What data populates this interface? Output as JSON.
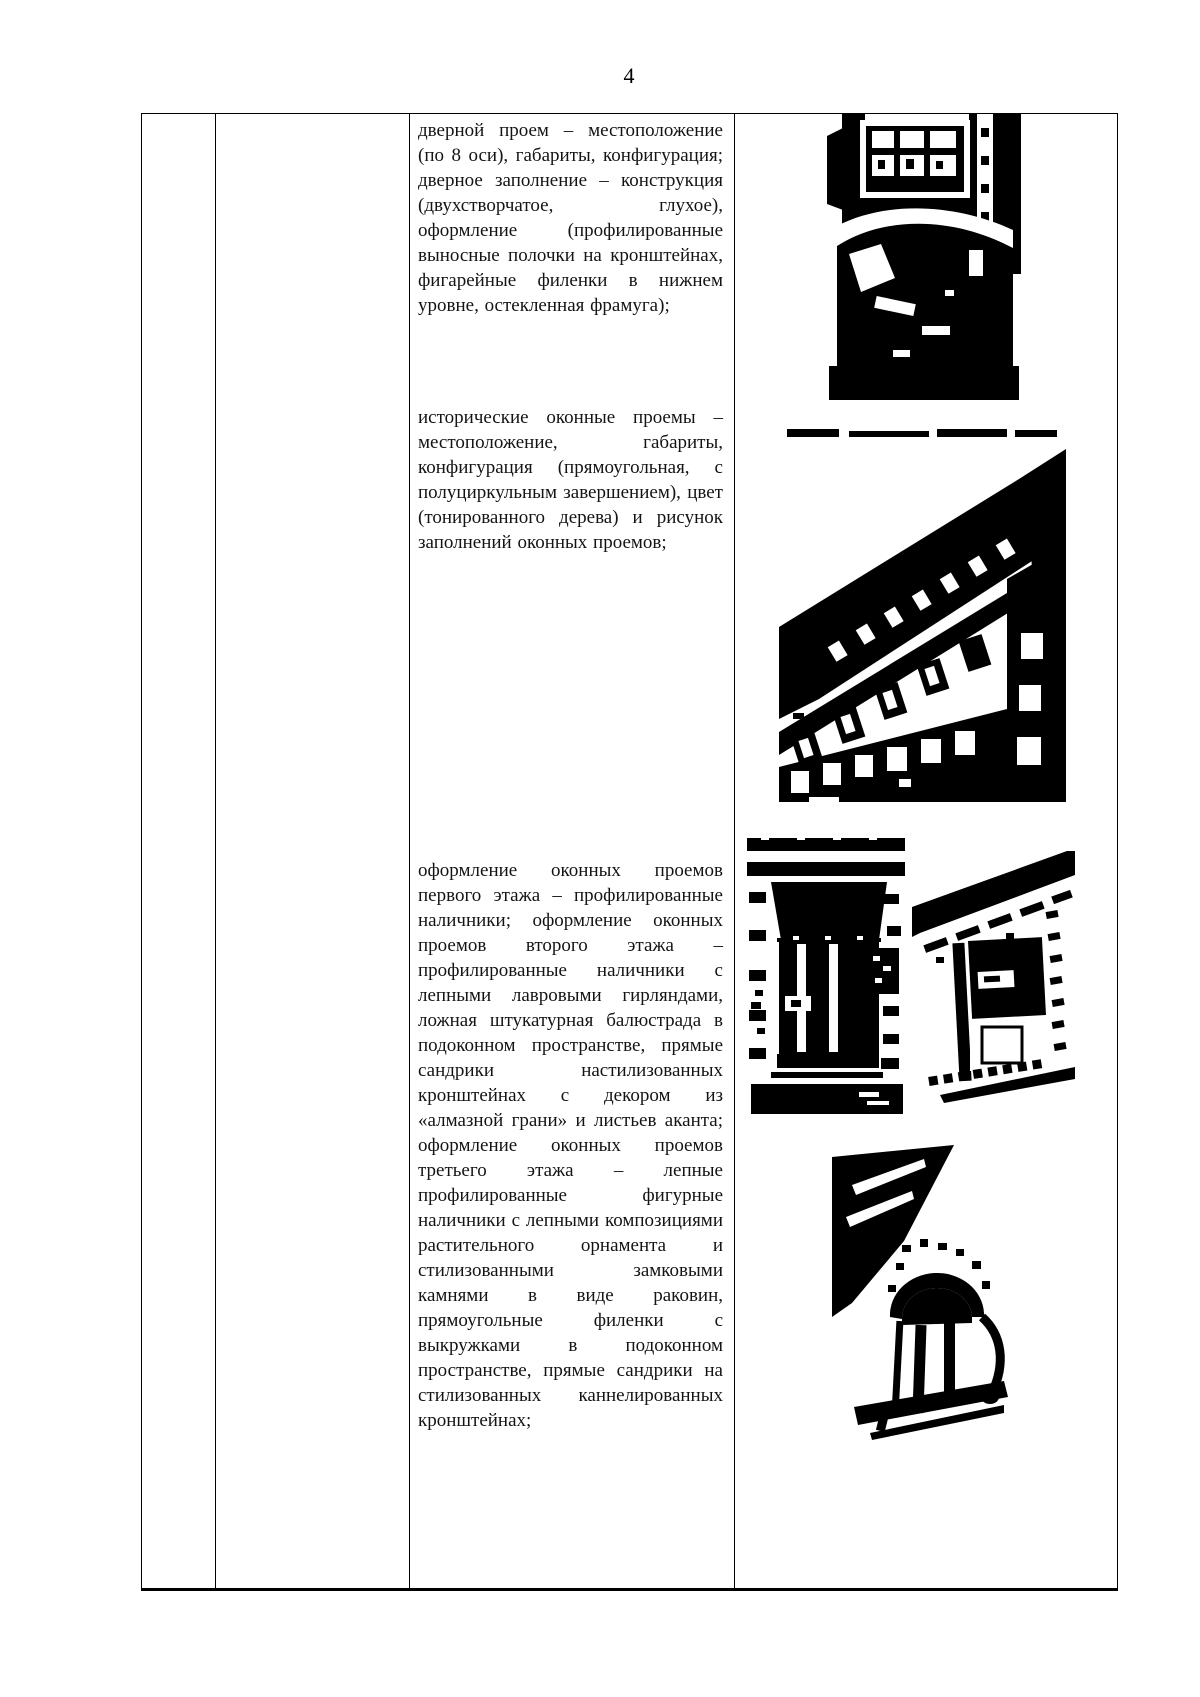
{
  "page_number": "4",
  "document": {
    "text_blocks": {
      "door": "дверной проем – местоположение (по 8 оси), габариты, конфигурация; дверное заполнение – конструкция (двухстворчатое, глухое), оформление (профилированные выносные полочки на кронштейнах, фигарейные филенки в нижнем уровне, остекленная фрамуга);",
      "windows": "исторические оконные проемы – местоположение, габариты, конфигурация (прямоугольная, с полуциркульным завершением), цвет (тонированного дерева) и рисунок заполнений оконных проемов;",
      "window_decor": "оформление оконных проемов первого этажа – профилированные наличники; оформление оконных проемов второго этажа – профилированные наличники с лепными лавровыми гирляндами, ложная штукатурная балюстрада в подоконном пространстве, прямые сандрики настилизованных кронштейнах с декором из «алмазной грани» и листьев аканта; оформление оконных проемов третьего этажа – лепные профилированные фигурные наличники с лепными композициями растительного орнамента и стилизованными замковыми камнями в виде раковин, прямоугольные филенки с выкружками в подоконном пространстве, прямые сандрики на стилизованных каннелированных кронштейнах;"
    }
  }
}
